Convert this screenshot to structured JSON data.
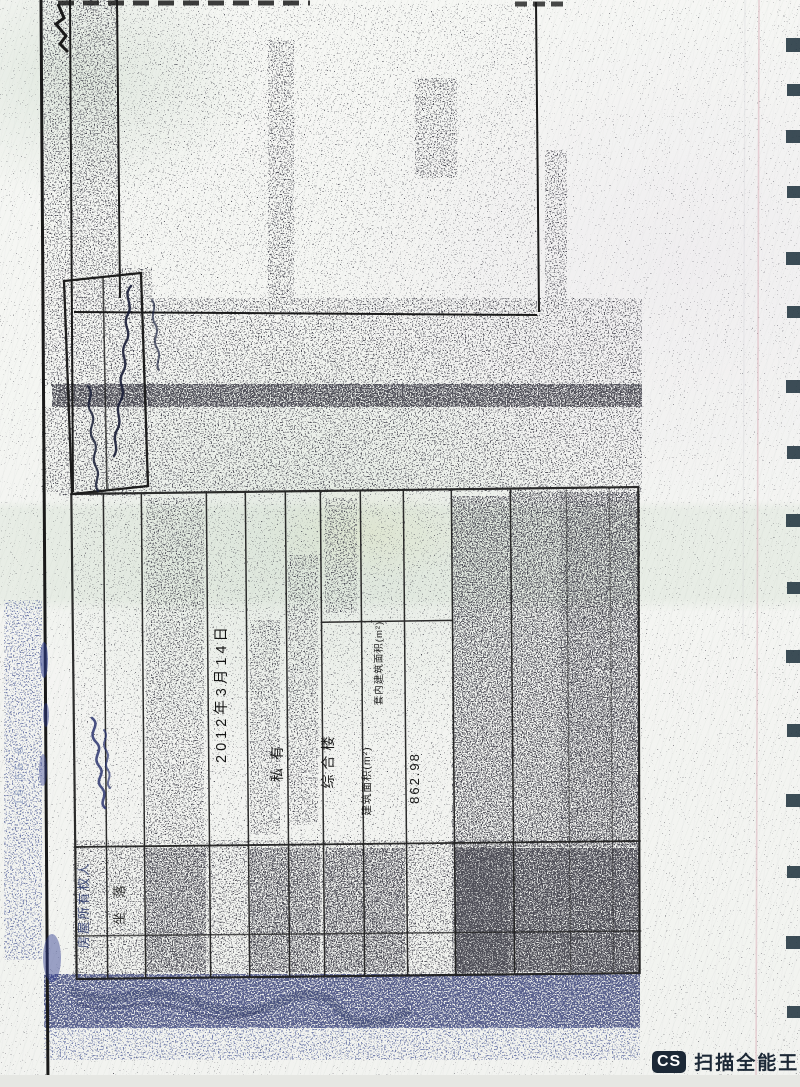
{
  "page": {
    "background_color": "#f5f6f3",
    "ink_color": "#1a1a1a",
    "blue_ink_color": "#2c3a6e"
  },
  "form": {
    "owner_label": "房屋所有权人",
    "location_label": "坐落",
    "registration_date": "2012年3月14日",
    "ownership_type": "私有",
    "building_use": "综合楼",
    "inner_floor_area_label": "套内建筑面积(m²)",
    "floor_area_label": "建筑面积(m²)",
    "floor_area_value": "862.98"
  },
  "margin_note": "16.65.6",
  "watermark": {
    "badge": "CS",
    "label": "扫描全能王",
    "color": "#1c2836"
  }
}
